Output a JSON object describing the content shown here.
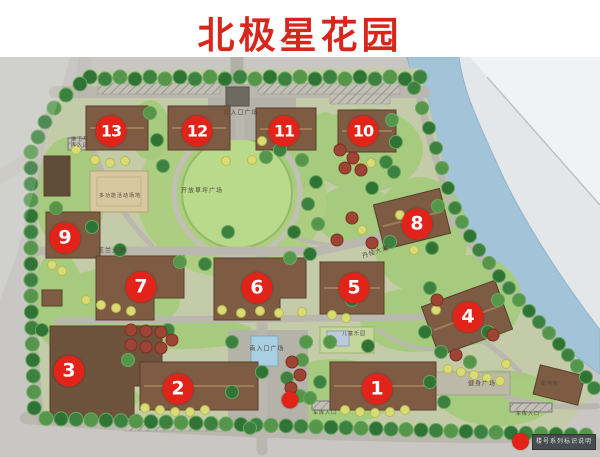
{
  "title": "北极星花园",
  "colors": {
    "title_red": "#d8261c",
    "badge_red": "#e2231a",
    "water_blue": "#a3c3d8"
  },
  "map": {
    "buildings": [
      {
        "num": "1",
        "x": 377,
        "y": 389
      },
      {
        "num": "2",
        "x": 178,
        "y": 389
      },
      {
        "num": "3",
        "x": 69,
        "y": 371
      },
      {
        "num": "4",
        "x": 468,
        "y": 317
      },
      {
        "num": "5",
        "x": 354,
        "y": 288
      },
      {
        "num": "6",
        "x": 257,
        "y": 288
      },
      {
        "num": "7",
        "x": 141,
        "y": 287
      },
      {
        "num": "8",
        "x": 417,
        "y": 224
      },
      {
        "num": "9",
        "x": 65,
        "y": 238
      },
      {
        "num": "10",
        "x": 363,
        "y": 131
      },
      {
        "num": "11",
        "x": 284,
        "y": 131
      },
      {
        "num": "12",
        "x": 197,
        "y": 131
      },
      {
        "num": "13",
        "x": 111,
        "y": 131
      }
    ],
    "labels": [
      {
        "id": "north-entrance-plaza",
        "text": "北入口广场",
        "x": 241,
        "y": 114,
        "size": 6
      },
      {
        "id": "open-lawn-plaza",
        "text": "开放草坪广场",
        "x": 202,
        "y": 192,
        "size": 6
      },
      {
        "id": "multifunction-court",
        "text": "多功能活动场地",
        "x": 120,
        "y": 197,
        "size": 5
      },
      {
        "id": "yulan-avenue",
        "text": "玉兰大道",
        "x": 112,
        "y": 252,
        "size": 6
      },
      {
        "id": "osmanthus-avenue",
        "text": "丹桂大道",
        "x": 376,
        "y": 253,
        "size": 6,
        "rot": -18
      },
      {
        "id": "south-entrance-plaza",
        "text": "南入口广场",
        "x": 267,
        "y": 350,
        "size": 6
      },
      {
        "id": "children-playground",
        "text": "儿童乐园",
        "x": 354,
        "y": 335,
        "size": 5
      },
      {
        "id": "fitness-plaza",
        "text": "健身广场",
        "x": 482,
        "y": 385,
        "size": 6
      },
      {
        "id": "power-room",
        "text": "配电房",
        "x": 550,
        "y": 385,
        "size": 5
      },
      {
        "id": "garage-entrance-nw",
        "text": "地下车\n库入口",
        "x": 80,
        "y": 143,
        "size": 5
      },
      {
        "id": "garage-entrance-sw",
        "text": "车库入口",
        "x": 325,
        "y": 414,
        "size": 5
      },
      {
        "id": "garage-entrance-se",
        "text": "车库入口",
        "x": 528,
        "y": 415,
        "size": 5
      }
    ],
    "location_dot": {
      "x": 290,
      "y": 400
    },
    "legend": {
      "caption": "楼号系列标识说明"
    }
  }
}
